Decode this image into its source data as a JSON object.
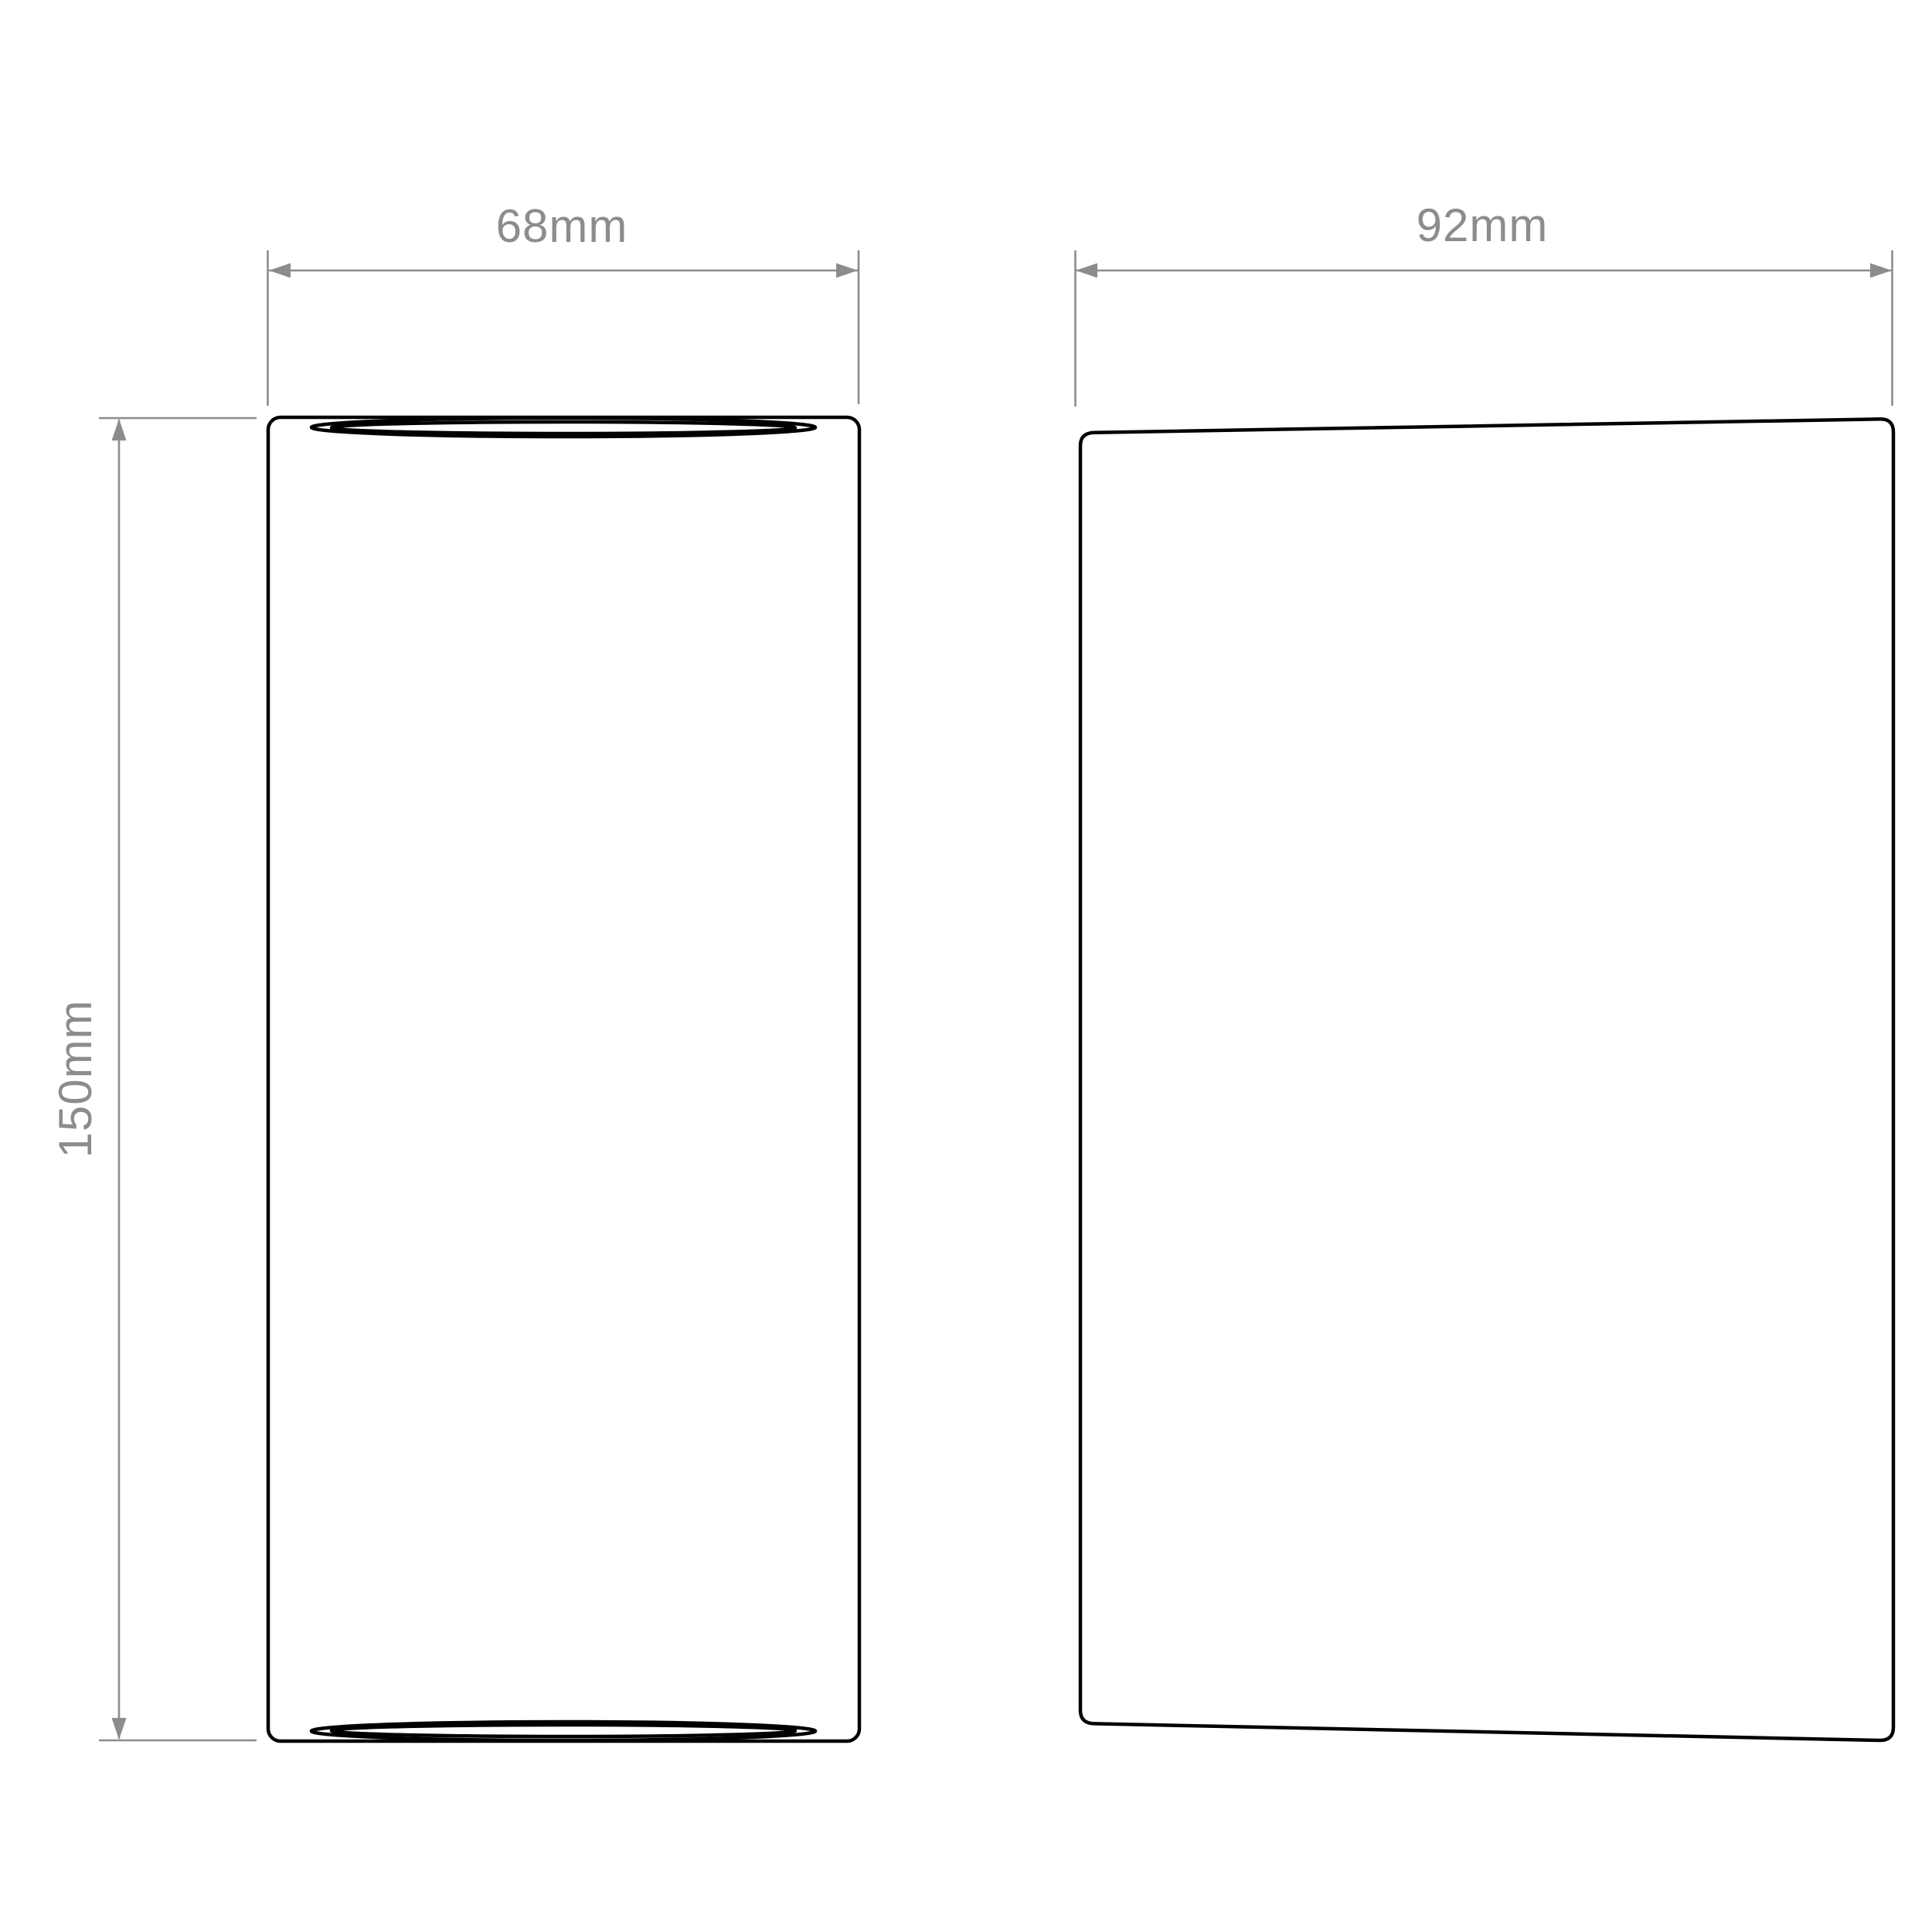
{
  "drawing": {
    "title": "wall-light-dimension-diagram",
    "background_color": "#ffffff",
    "outline_color": "#000000",
    "dimension_color": "#8c8c8c",
    "views": [
      {
        "id": "front-view",
        "shape": "rounded rectangle with flattened ellipse openings at top and bottom"
      },
      {
        "id": "side-view",
        "shape": "rounded rectangle with slanted top and bottom edges"
      }
    ],
    "dimensions": {
      "front_width": {
        "label": "68mm",
        "value": 68,
        "unit": "mm"
      },
      "side_width": {
        "label": "92mm",
        "value": 92,
        "unit": "mm"
      },
      "height": {
        "label": "150mm",
        "value": 150,
        "unit": "mm"
      }
    }
  }
}
